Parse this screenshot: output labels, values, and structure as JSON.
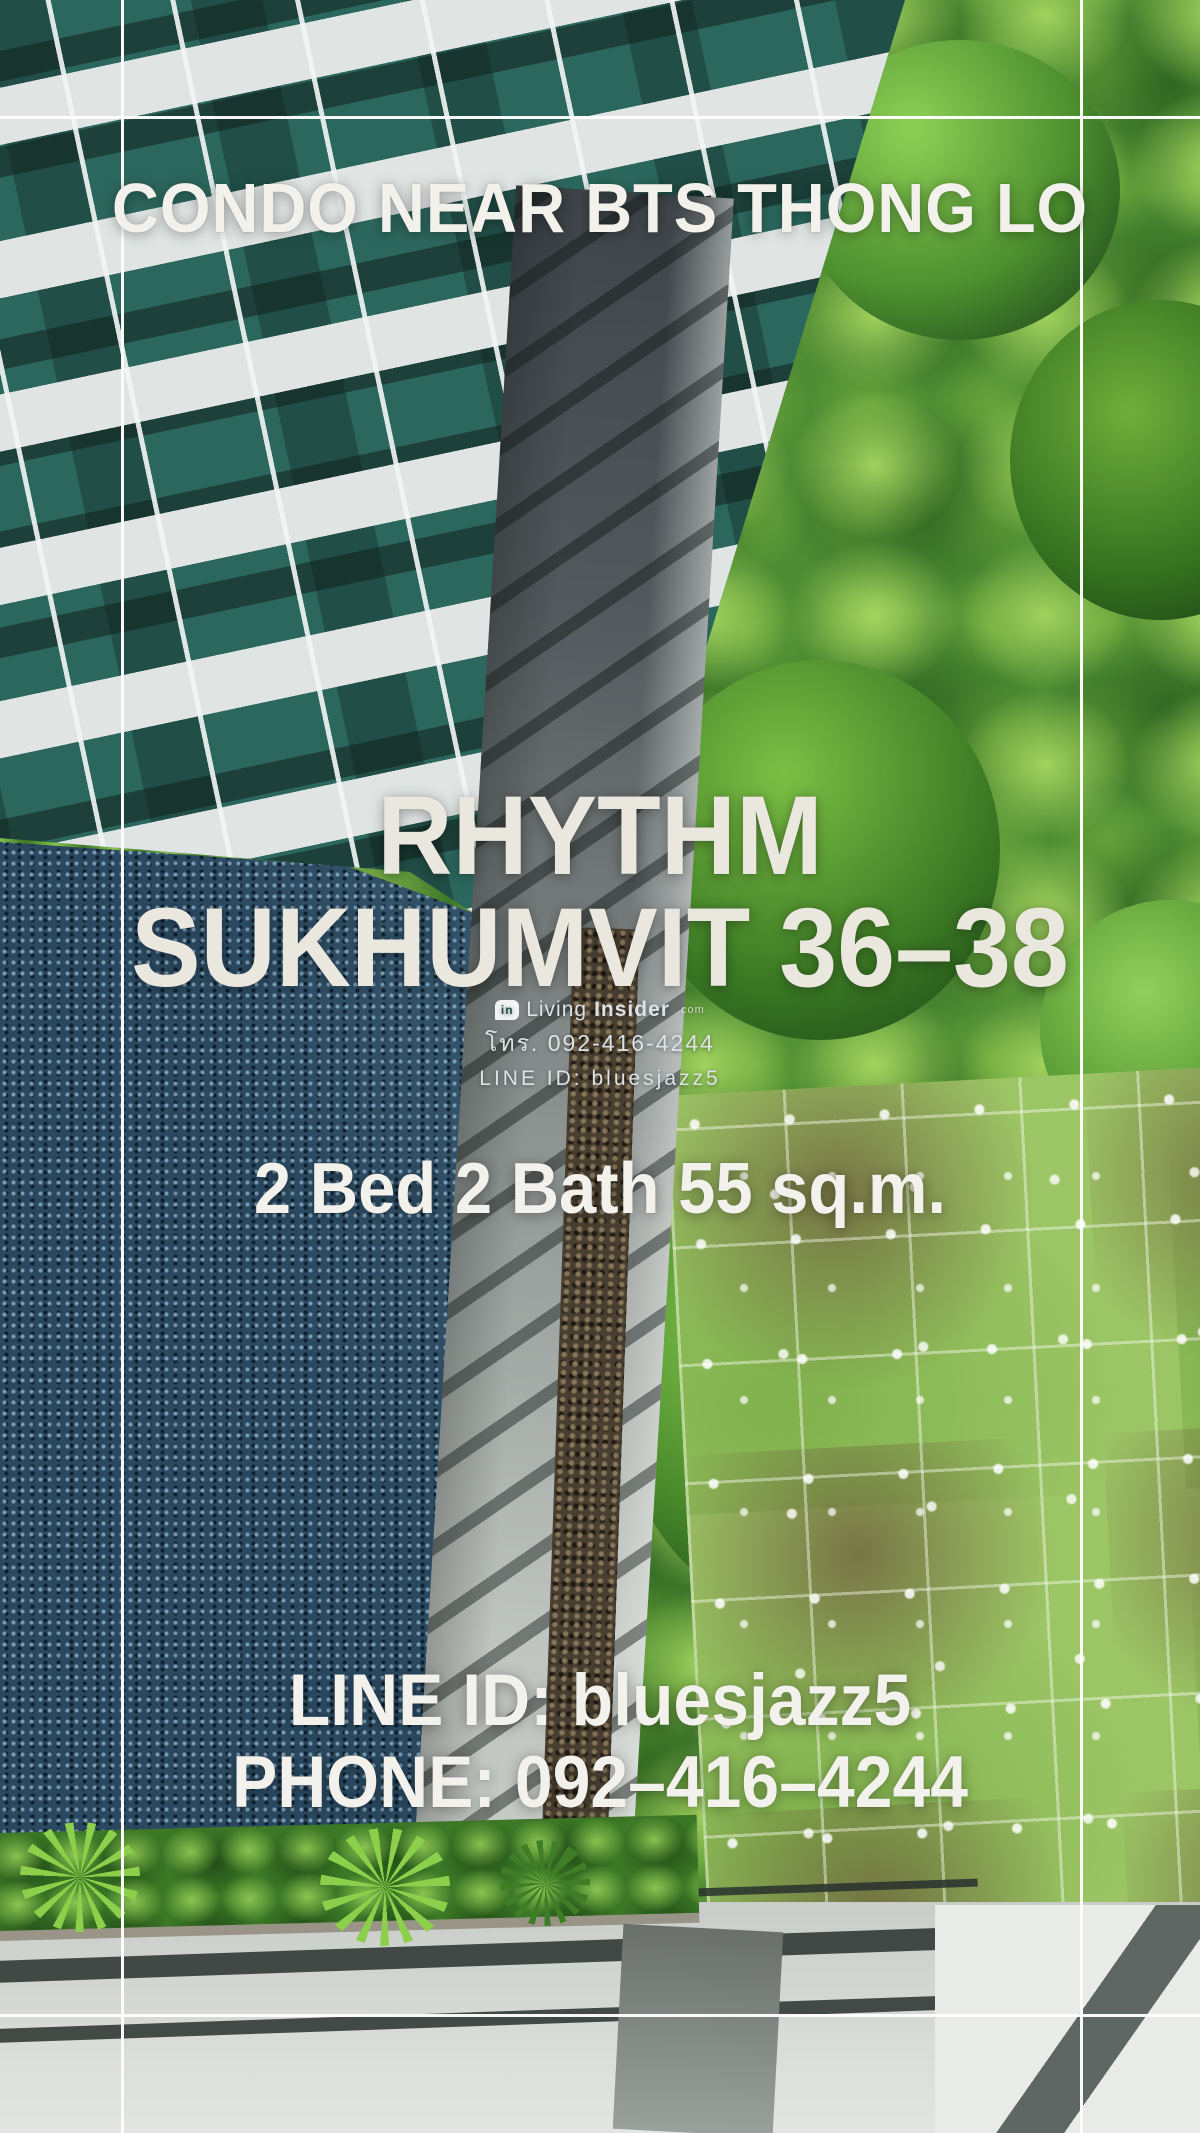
{
  "poster": {
    "headline": "CONDO NEAR BTS THONG LO",
    "title_line1": "RHYTHM",
    "title_line2": "SUKHUMVIT 36–38",
    "specs": "2 Bed 2 Bath 55 sq.m.",
    "contact_line1": "LINE ID: bluesjazz5",
    "contact_line2": "PHONE: 092–416–4244"
  },
  "watermark": {
    "brand_light": "Living",
    "brand_bold": "Insider",
    "brand_suffix": ".com",
    "logo_icon": "livinginsider-bubble-icon",
    "logo_glyph": "in",
    "phone": "โทร. 092-416-4244",
    "line_id": "LINE ID: bluesjazz5"
  },
  "palette": {
    "text_white": "#f2f1ec",
    "title_cream": "#eae7df",
    "frame_white": "#ffffff",
    "pool_blue": "#2a4961",
    "foliage_green": "#4f8c33",
    "lawn_green": "#9cc565",
    "window_teal": "#2c675d",
    "building_white": "#e0e5e4",
    "walkway_gray": "#8e9492"
  }
}
